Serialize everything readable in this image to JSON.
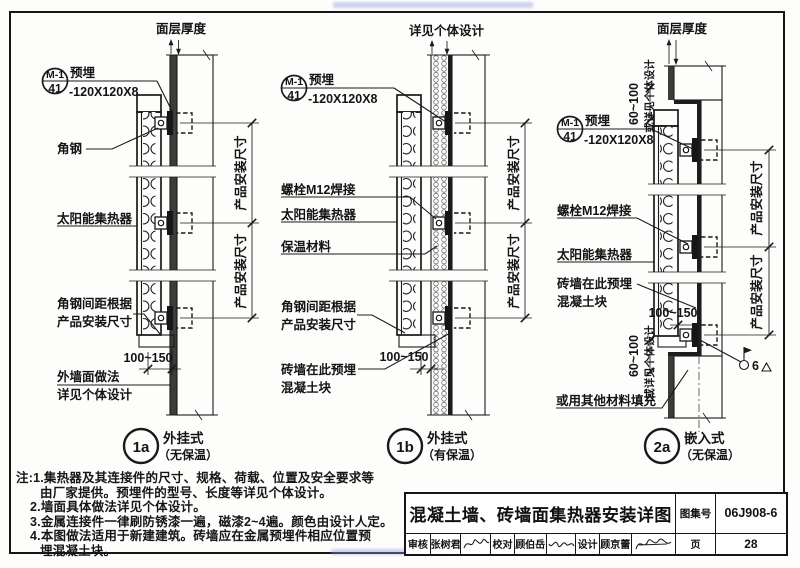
{
  "colors": {
    "line": "#1a1a1a",
    "paper": "#fdfdfc",
    "face_layer": "#3f3b38"
  },
  "d1a": {
    "bubble_num": "1a",
    "bubble_name": "外挂式",
    "bubble_sub": "（无保温）",
    "top_dim": "面层厚度",
    "mark_top": "M-1",
    "mark_bottom": "41",
    "mark_text1": "预埋",
    "mark_text2": "-120X120X8",
    "label_angle": "角钢",
    "label_collector": "太阳能集热器",
    "label_spacing1": "角钢间距根据",
    "label_spacing2": "产品安装尺寸",
    "dim_gap": "100~150",
    "label_wall1": "外墙面做法",
    "label_wall2": "详见个体设计",
    "dim_product": "产品安装尺寸"
  },
  "d1b": {
    "bubble_num": "1b",
    "bubble_name": "外挂式",
    "bubble_sub": "（有保温）",
    "top_dim": "详见个体设计",
    "mark_top": "M-1",
    "mark_bottom": "41",
    "mark_text1": "预埋",
    "mark_text2": "-120X120X8",
    "label_bolt": "螺栓M12焊接",
    "label_collector": "太阳能集热器",
    "label_insulation": "保温材料",
    "label_spacing1": "角钢间距根据",
    "label_spacing2": "产品安装尺寸",
    "dim_gap": "100~150",
    "label_brick1": "砖墙在此预埋",
    "label_brick2": "混凝土块",
    "dim_product": "产品安装尺寸"
  },
  "d2a": {
    "bubble_num": "2a",
    "bubble_name": "嵌入式",
    "bubble_sub": "（无保温）",
    "top_dim": "面层厚度",
    "dim_niche": "60~100",
    "dim_niche_alt": "或详见个体设计",
    "mark_top": "M-1",
    "mark_bottom": "41",
    "mark_text1": "预埋",
    "mark_text2": "-120X120X8",
    "label_bolt": "螺栓M12焊接",
    "label_collector": "太阳能集热器",
    "label_brick1": "砖墙在此预埋",
    "label_brick2": "混凝土块",
    "dim_gap": "100~150",
    "label_fill": "或用其他材料填充",
    "weld_size": "6",
    "dim_product": "产品安装尺寸"
  },
  "notes": [
    "注:1.集热器及其连接件的尺寸、规格、荷载、位置及安全要求等",
    "由厂家提供。预埋件的型号、长度等详见个体设计。",
    "2.墙面具体做法详见个体设计。",
    "3.金属连接件一律刷防锈漆一遍，磁漆2~4遍。颜色由设计人定。",
    "4.本图做法适用于新建建筑。砖墙应在金属预埋件相应位置预",
    "埋混凝土块。"
  ],
  "titleblock": {
    "title": "混凝土墙、砖墙面集热器安装详图",
    "atlas_label": "图集号",
    "atlas_no": "06J908-6",
    "page_label": "页",
    "page_no": "28",
    "audit_label": "审核",
    "audit_name": "张树君",
    "check_label": "校对",
    "check_name": "顾伯岳",
    "design_label": "设计",
    "design_name": "顾京蕾"
  }
}
